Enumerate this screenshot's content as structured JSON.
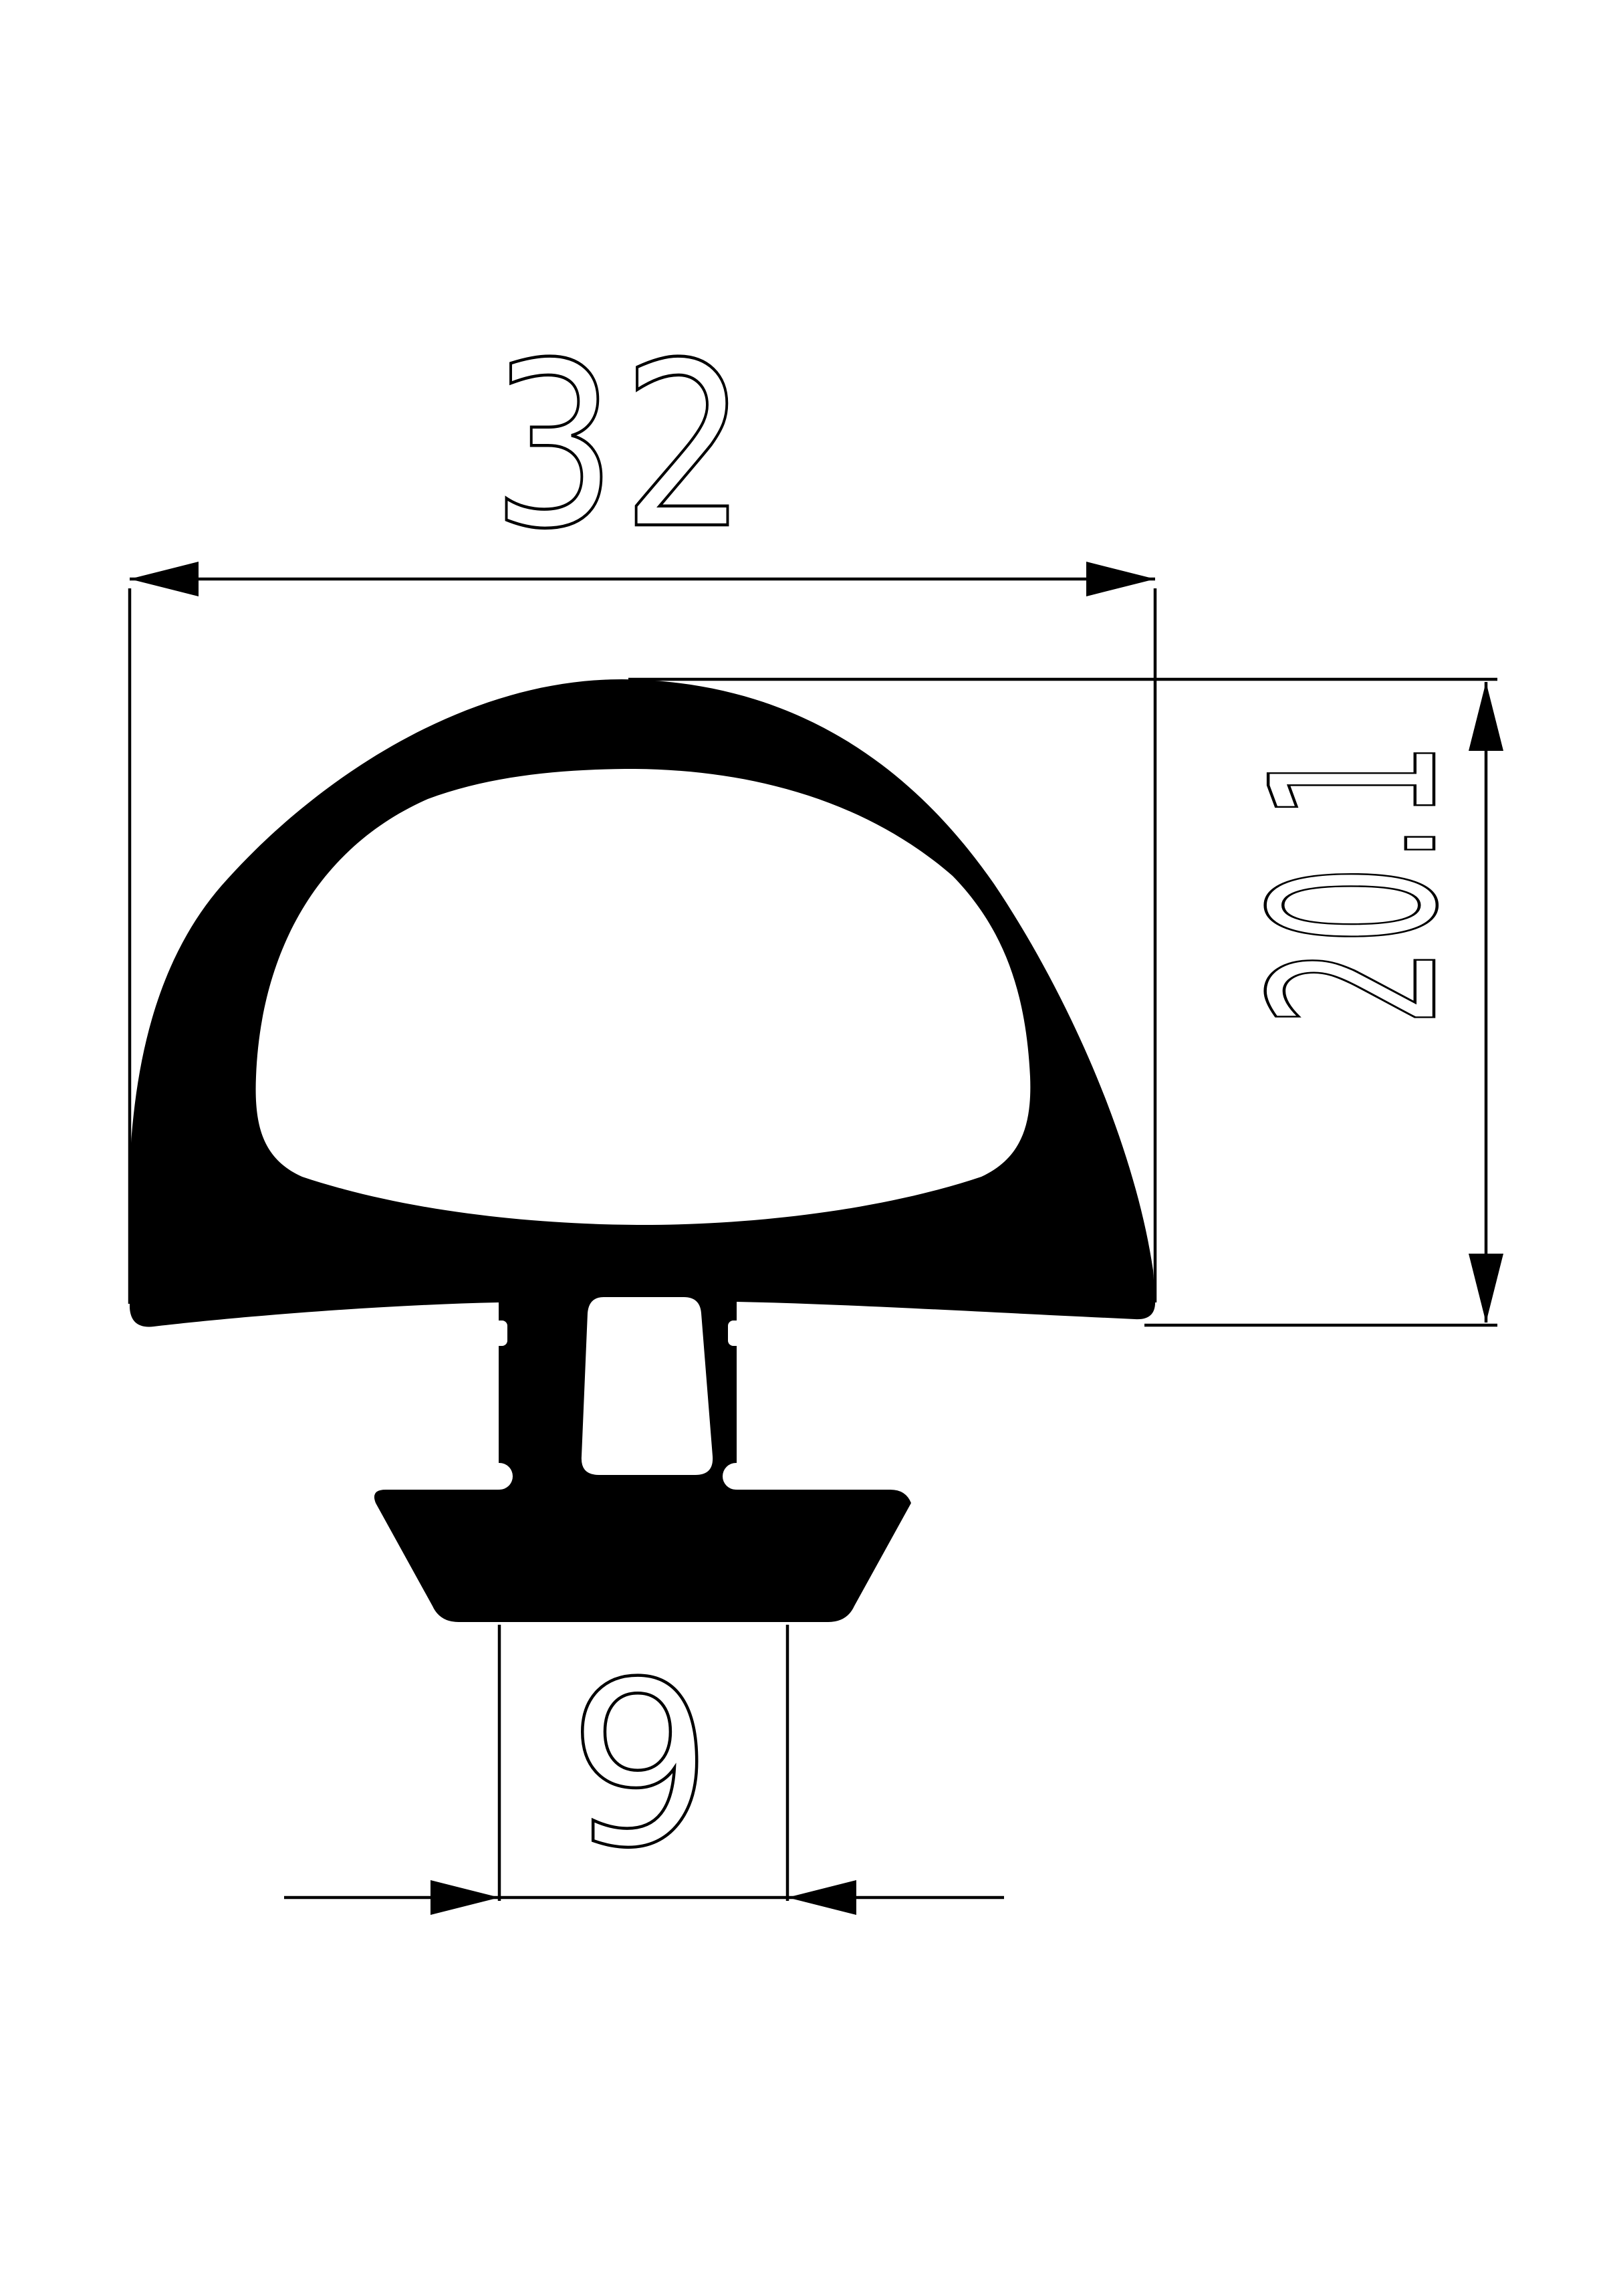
{
  "drawing": {
    "title": "rubber-seal-profile-cross-section",
    "background_color": "#ffffff",
    "line_color": "#000000",
    "dimensions": {
      "width": {
        "value": "32",
        "orientation": "horizontal",
        "position": "top"
      },
      "height": {
        "value": "20.1",
        "orientation": "vertical-rotated",
        "position": "right"
      },
      "foot_width": {
        "value": "9",
        "orientation": "horizontal",
        "position": "bottom"
      }
    }
  }
}
